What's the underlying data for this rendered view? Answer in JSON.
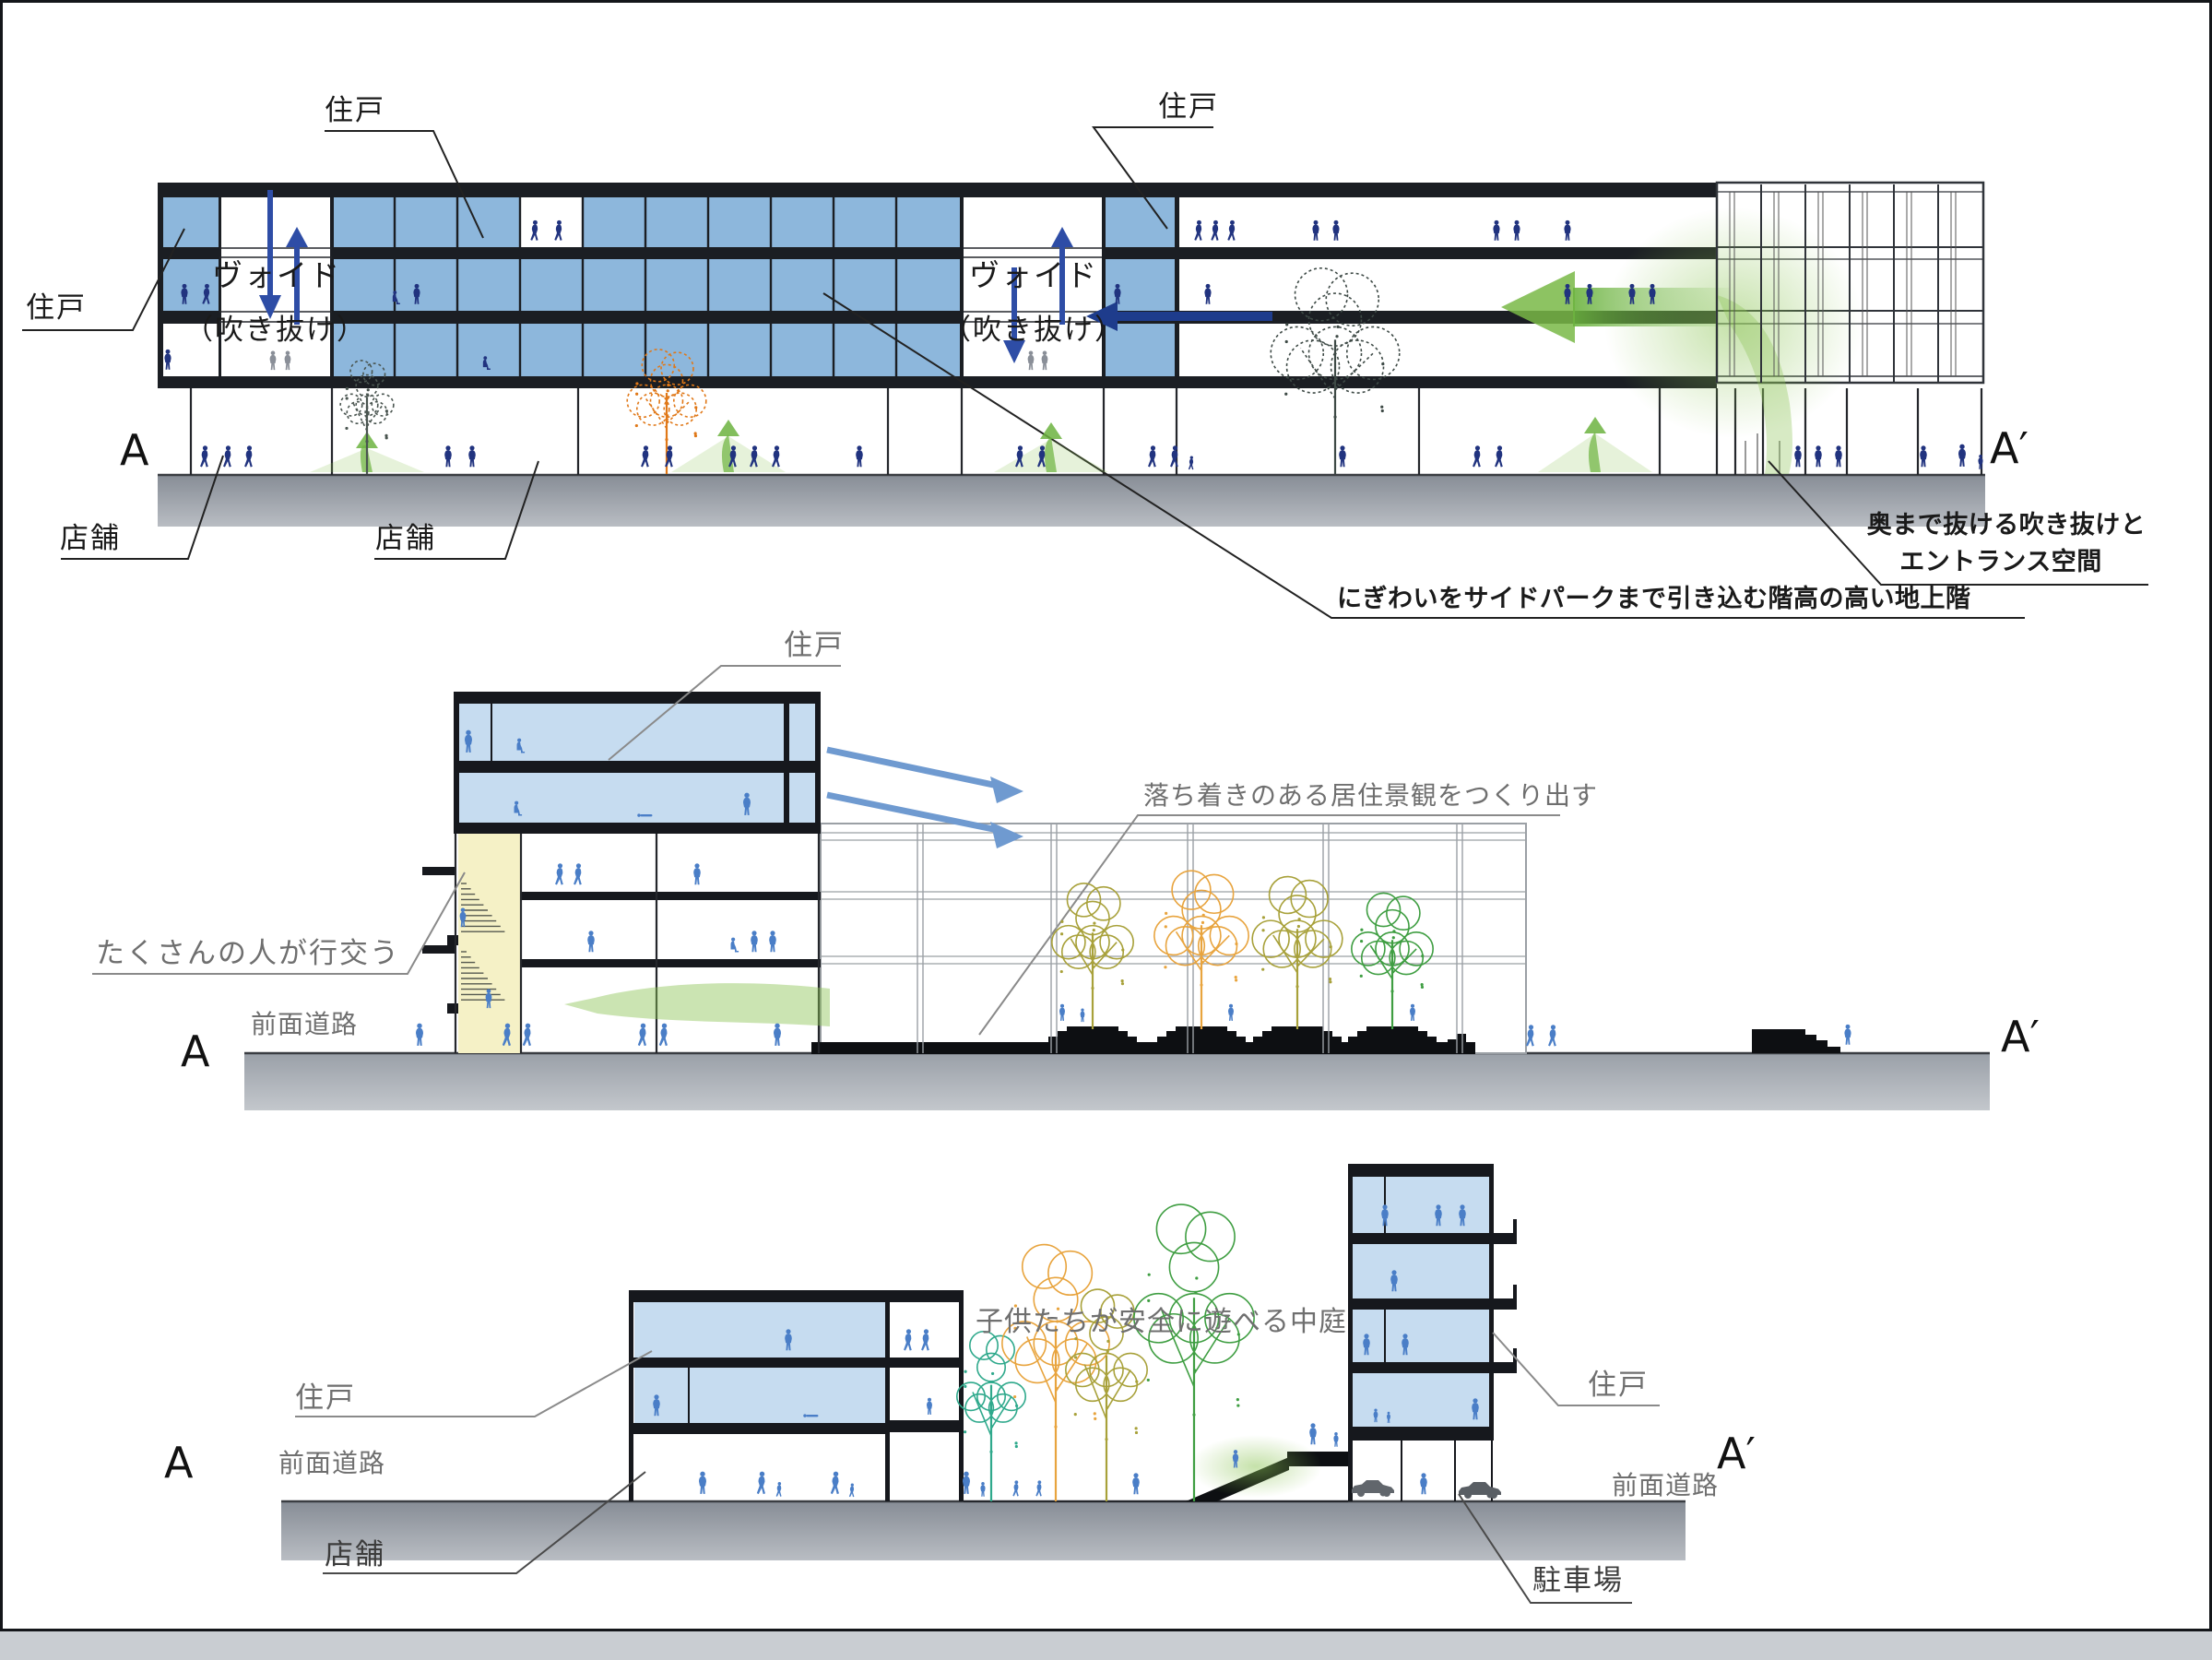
{
  "colors": {
    "section_blue": "#8db7dc",
    "light_blue": "#c6dcf0",
    "band_black": "#1b1e23",
    "people_navy": "#21337f",
    "people_blue": "#4a7ec7",
    "stair_yellow": "#f5f1c6",
    "road_dark": "#8b9199",
    "road_light": "#ced2d7",
    "green": "#7ab648",
    "arrow_blue": "#2e4da6"
  },
  "sections": {
    "top": {
      "marker_left": "A",
      "marker_right": "A′",
      "labels": {
        "unit_top": "住戸",
        "unit_right": "住戸",
        "unit_left": "住戸",
        "shop_left": "店舗",
        "shop_center": "店舗",
        "void1_line1": "ヴォイド",
        "void1_line2": "（吹き抜け）",
        "void2_line1": "ヴォイド",
        "void2_line2": "（吹き抜け）"
      },
      "annotations": {
        "entrance_line1": "奥まで抜ける吹き抜けと",
        "entrance_line2": "エントランス空間",
        "ground_floor": "にぎわいをサイドパークまで引き込む階高の高い地上階"
      }
    },
    "middle": {
      "marker_left": "A",
      "marker_right": "A′",
      "labels": {
        "unit": "住戸",
        "front_road": "前面道路"
      },
      "annotations": {
        "crowd": "たくさんの人が行交う",
        "calm": "落ち着きのある居住景観をつくり出す"
      }
    },
    "bottom": {
      "marker_left": "A",
      "marker_right": "A′",
      "labels": {
        "unit_left": "住戸",
        "unit_right": "住戸",
        "shop": "店舗",
        "parking": "駐車場",
        "front_road_left": "前面道路",
        "front_road_right": "前面道路"
      },
      "annotations": {
        "courtyard": "子供たちが安全に遊べる中庭"
      }
    }
  }
}
